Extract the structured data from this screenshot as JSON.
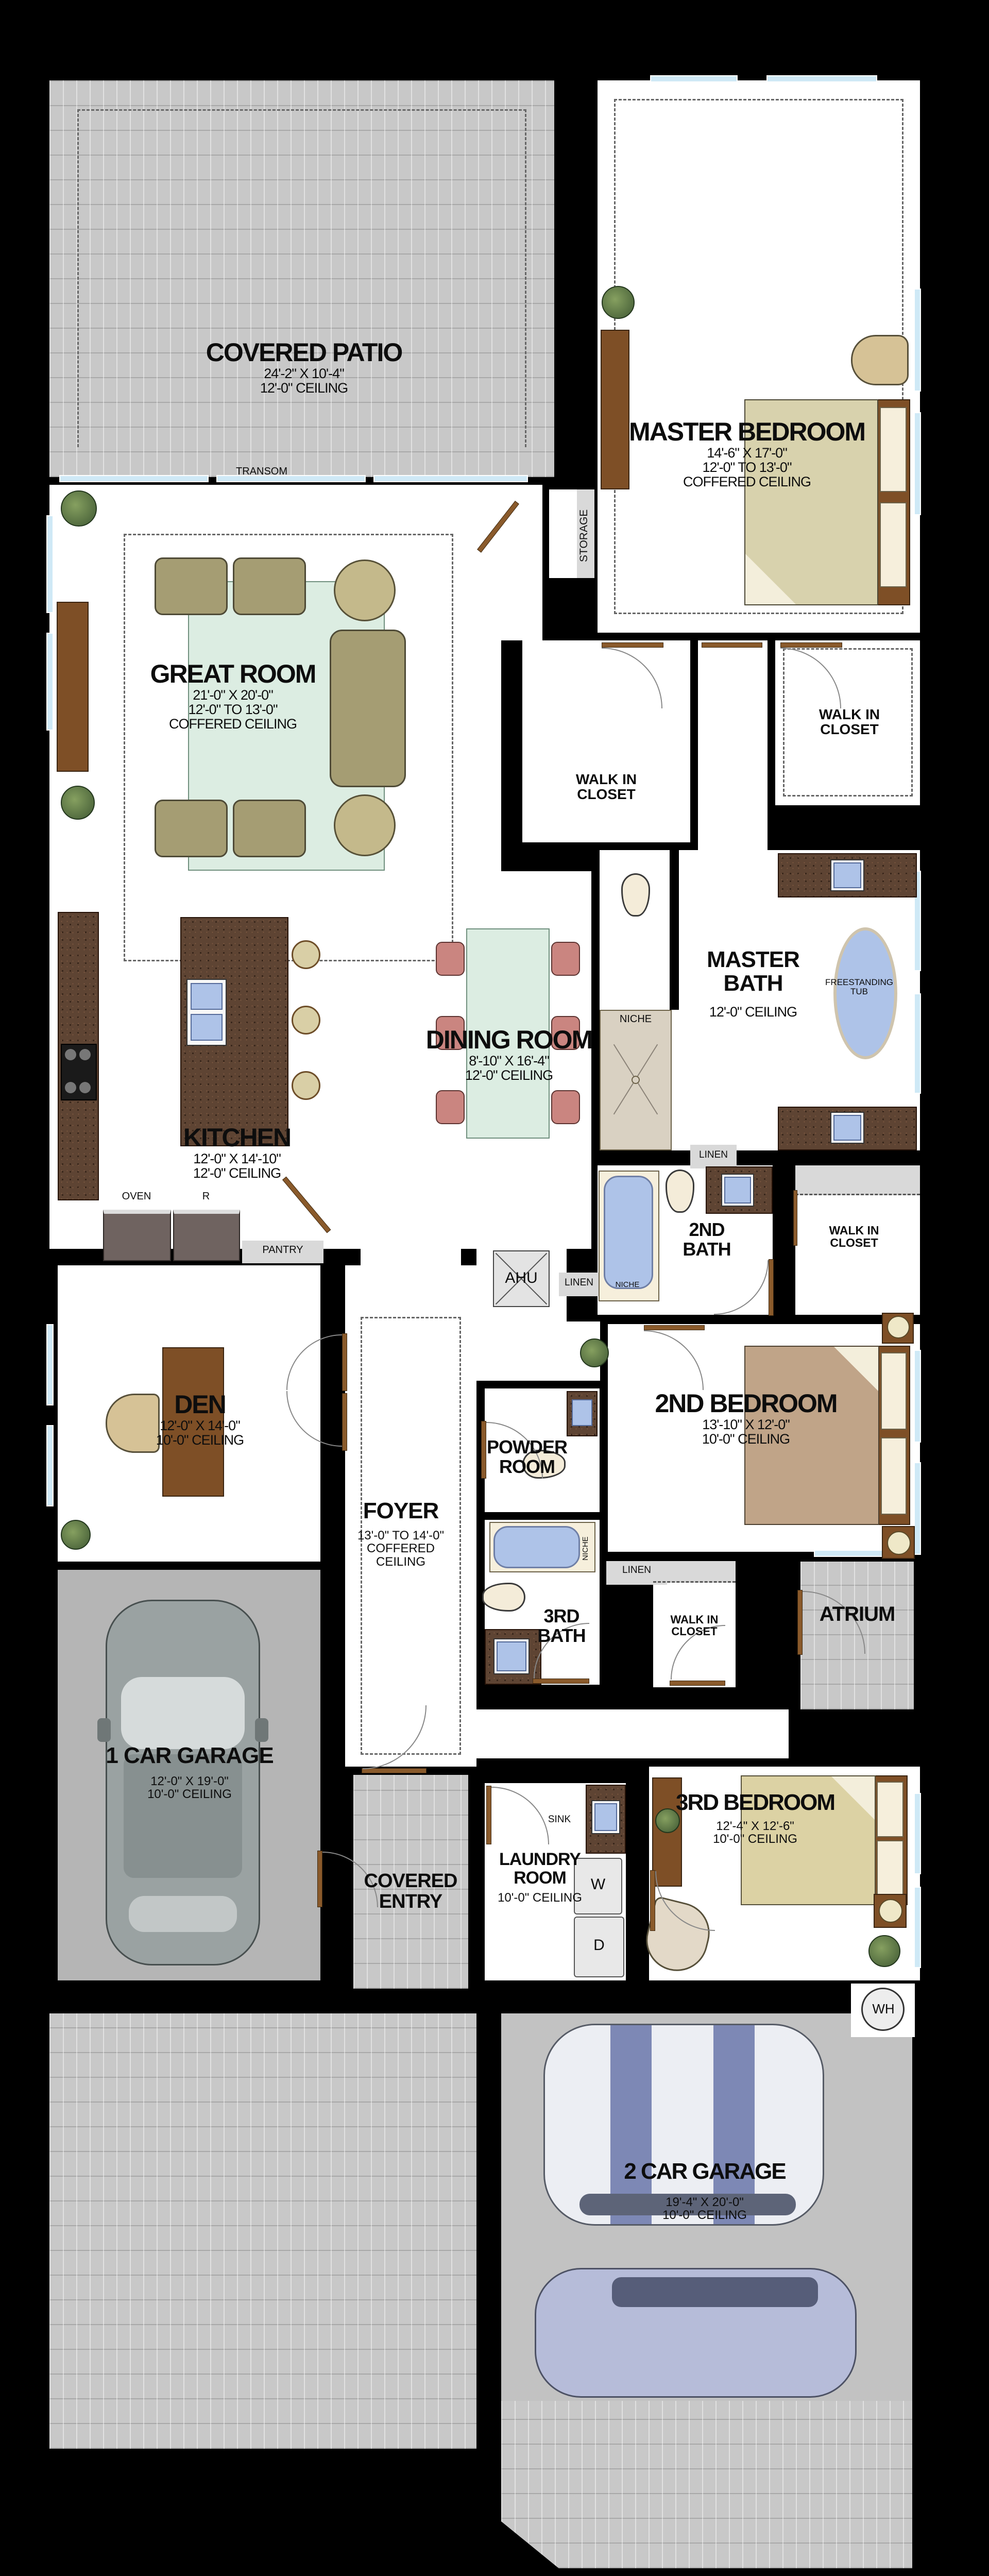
{
  "rooms": {
    "covered_patio": {
      "name": "COVERED PATIO",
      "dim": "24'-2\" X 10'-4\"",
      "ceiling": "12'-0\" CEILING"
    },
    "great_room": {
      "name": "GREAT ROOM",
      "dim": "21'-0\" X 20'-0\"",
      "ceiling": "12'-0\" TO 13'-0\"",
      "ceiling2": "COFFERED CEILING"
    },
    "master_bedroom": {
      "name": "MASTER BEDROOM",
      "dim": "14'-6\" X 17'-0\"",
      "ceiling": "12'-0\" TO 13'-0\"",
      "ceiling2": "COFFERED CEILING"
    },
    "master_bath": {
      "line1": "MASTER",
      "line2": "BATH",
      "ceiling": "12'-0\" CEILING"
    },
    "dining_room": {
      "name": "DINING ROOM",
      "dim": "8'-10\" X 16'-4\"",
      "ceiling": "12'-0\" CEILING"
    },
    "kitchen": {
      "name": "KITCHEN",
      "dim": "12'-0\" X 14'-10\"",
      "ceiling": "12'-0\" CEILING"
    },
    "den": {
      "name": "DEN",
      "dim": "12'-0\" X 14'-0\"",
      "ceiling": "10'-0\" CEILING"
    },
    "second_bath": {
      "line1": "2ND",
      "line2": "BATH"
    },
    "second_bedroom": {
      "name": "2ND BEDROOM",
      "dim": "13'-10\" X 12'-0\"",
      "ceiling": "10'-0\" CEILING"
    },
    "powder_room": {
      "line1": "POWDER",
      "line2": "ROOM"
    },
    "foyer": {
      "name": "FOYER",
      "ceiling": "13'-0\" TO 14'-0\"",
      "ceiling2": "COFFERED",
      "ceiling3": "CEILING"
    },
    "third_bath": {
      "line1": "3RD",
      "line2": "BATH"
    },
    "walk_in_closet": {
      "line1": "WALK IN",
      "line2": "CLOSET"
    },
    "atrium": {
      "name": "ATRIUM"
    },
    "one_car_garage": {
      "name": "1 CAR GARAGE",
      "dim": "12'-0\" X 19'-0\"",
      "ceiling": "10'-0\" CEILING"
    },
    "covered_entry": {
      "line1": "COVERED",
      "line2": "ENTRY"
    },
    "laundry_room": {
      "line1": "LAUNDRY",
      "line2": "ROOM",
      "ceiling": "10'-0\" CEILING"
    },
    "third_bedroom": {
      "name": "3RD BEDROOM",
      "dim": "12'-4\" X 12'-6\"",
      "ceiling": "10'-0\" CEILING"
    },
    "two_car_garage": {
      "name": "2 CAR GARAGE",
      "dim": "19'-4\" X 20'-0\"",
      "ceiling": "10'-0\" CEILING"
    }
  },
  "fixtures": {
    "transom": "TRANSOM",
    "storage": "STORAGE",
    "freestanding": "FREESTANDING",
    "tub": "TUB",
    "niche": "NICHE",
    "linen": "LINEN",
    "pantry": "PANTRY",
    "oven": "OVEN",
    "refrigerator": "R",
    "ahu": "AHU",
    "sink": "SINK",
    "washer": "W",
    "dryer": "D",
    "water_heater": "WH"
  },
  "colors": {
    "wall": "#000000",
    "floor": "#ffffff",
    "paver": "#c8c8c8",
    "garage_floor": "#b5b5b5",
    "granite": "#5e4433",
    "wood": "#7e4f26",
    "water_blue": "#aec3e8",
    "rug_mint": "#dcede2",
    "sofa_khaki": "#a59d73",
    "chair_pink": "#ca8580",
    "bed_tan": "#d8d2ad",
    "window_blue": "#cfe9f6"
  }
}
